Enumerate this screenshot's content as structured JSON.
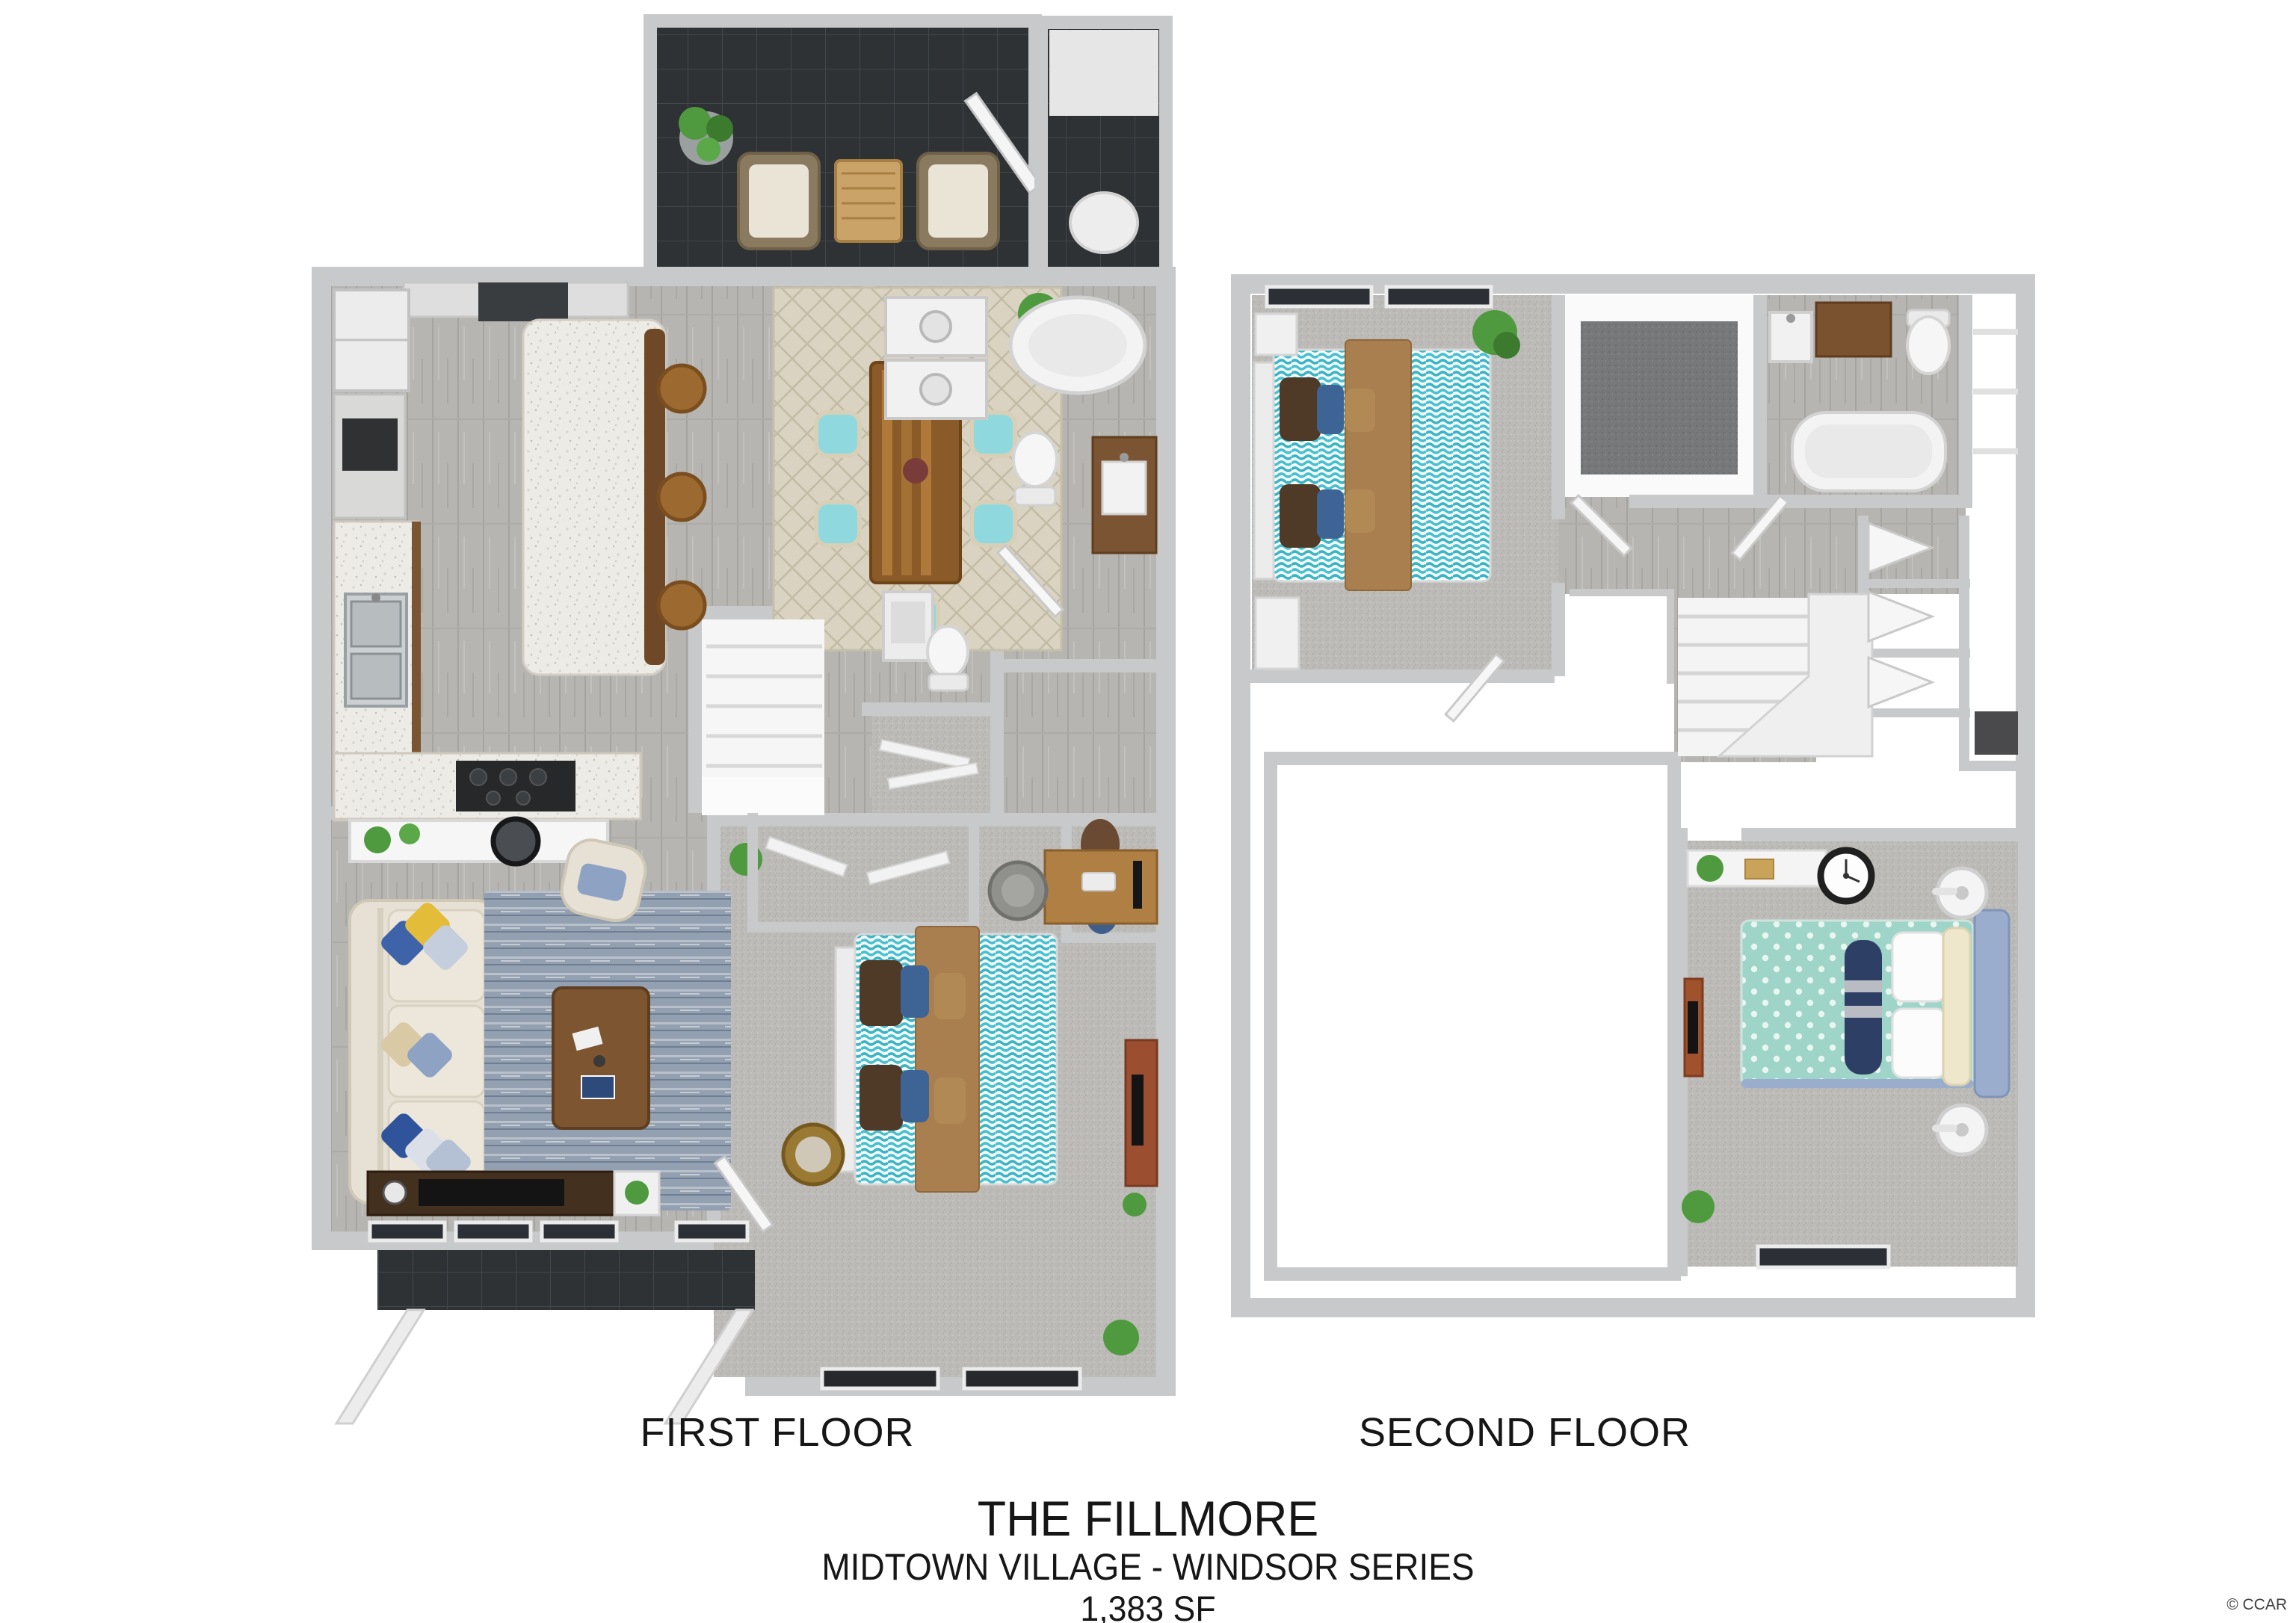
{
  "labels": {
    "first_floor": "FIRST FLOOR",
    "second_floor": "SECOND FLOOR"
  },
  "title": {
    "plan_name": "THE FILLMORE",
    "community": "MIDTOWN VILLAGE - WINDSOR SERIES",
    "area": "1,383 SF"
  },
  "watermark": "© CCAR",
  "colors": {
    "bg": "#ffffff",
    "text": "#161616",
    "watermark": "#3f3f3f",
    "wall": "#c7c9ca",
    "tile-dark": "#2e3235",
    "wood-floor": "#b6b5b2",
    "carpet": "#bcbbb8",
    "carpet-dark": "#77787a",
    "granite": "#edebe6",
    "cabinet-brown": "#7b5434",
    "island-brown": "#6f4827",
    "stool-brown": "#9c6a30",
    "table-wood": "#8a5a28",
    "desk-wood": "#b07f44",
    "dresser-red": "#9c4f30",
    "teal-bedding": "#3cb4c4",
    "mint-duvet": "#9fd4c9",
    "tan-blanket": "#a97f4f",
    "pillow-brown": "#4f3a28",
    "pillow-navy": "#3e6496",
    "navy-roll": "#2e3f66",
    "headboard-blue": "#9badcc",
    "sofa-cream": "#e6e1d4",
    "rug-blue": "#93a0b1",
    "rug-beige": "#dad3c1",
    "chair-teal": "#8fd9de",
    "plant-green": "#4f9a3e",
    "window-dark": "#2c3036"
  }
}
